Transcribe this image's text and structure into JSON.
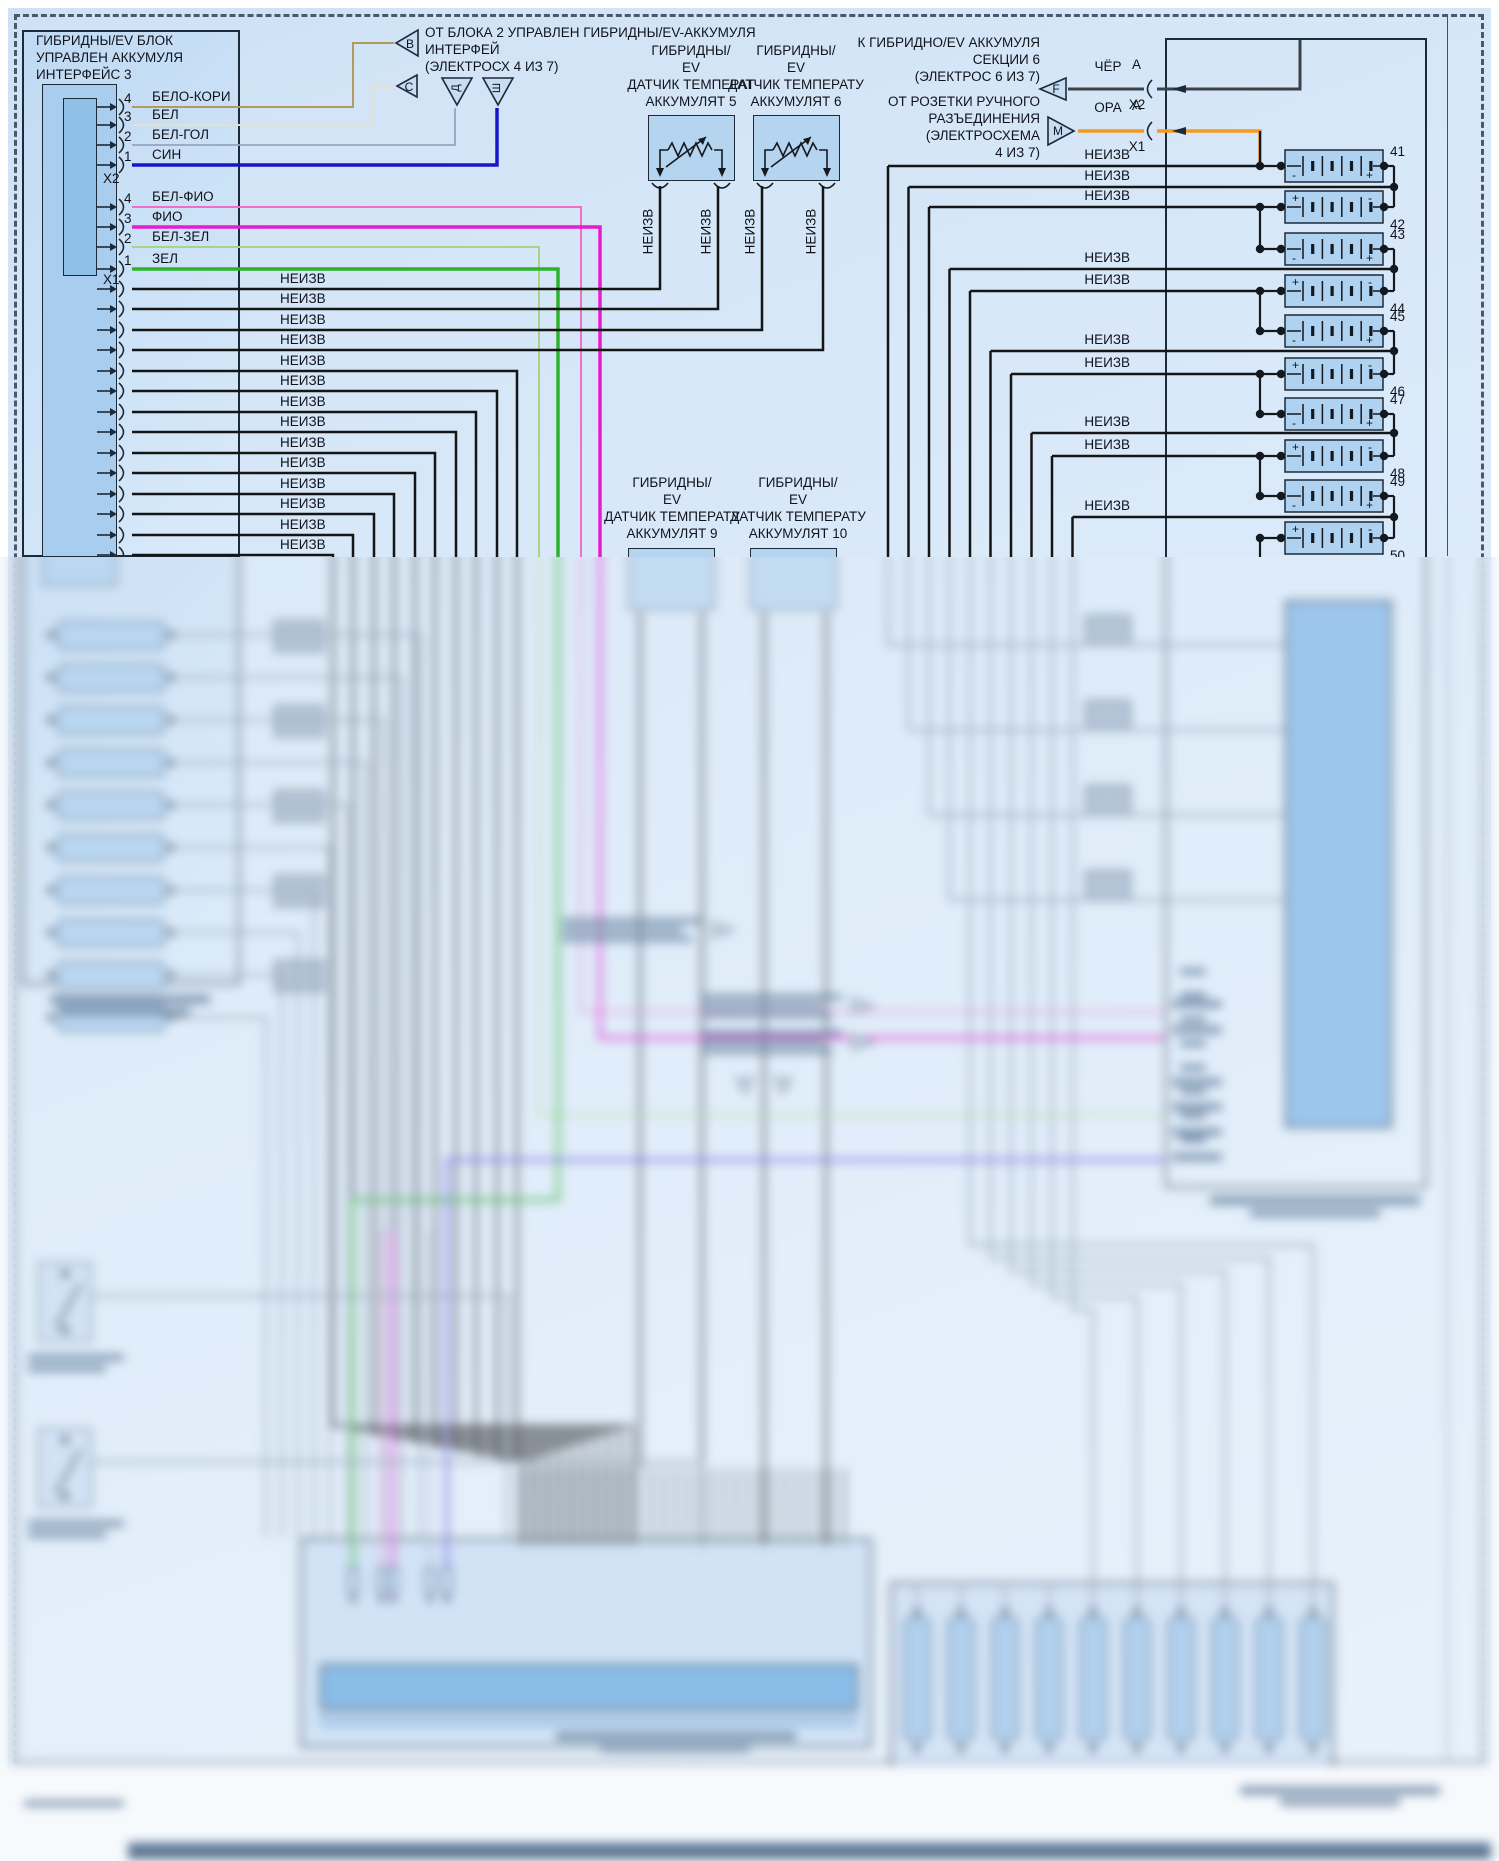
{
  "palette": {
    "diagram_bg": "#dcebfa",
    "block_fill": "#c6ddf3",
    "inner_fill": "#a9cdee",
    "inner_fill2": "#8fc0e8",
    "cell_fill": "#aed2f0",
    "line_dark": "#1c2a3a",
    "wire_black": "#151515",
    "wire_tan": "#b29b5e",
    "wire_white": "#e4e0cf",
    "wire_pale_blue": "#99a3c4",
    "wire_blue": "#1616c8",
    "wire_pink": "#f06ec8",
    "wire_magenta": "#e51cd0",
    "wire_pale_green": "#a6d584",
    "wire_green": "#2cb32c",
    "wire_gray": "#7d8da1",
    "wire_orange": "#f59a1c",
    "wire_dark_gray": "#3c4147",
    "wire_violet": "#6a5ae0"
  },
  "left_block": {
    "title_lines": [
      "ГИБРИДНЫ/EV БЛОК",
      "УПРАВЛЕН АККУМУЛЯ",
      "ИНТЕРФЕЙС 3"
    ],
    "x2_label": "X2",
    "x1_label": "X1",
    "x2_pins": [
      {
        "num": "4",
        "wire": "БЕЛО-КОРИ"
      },
      {
        "num": "3",
        "wire": "БЕЛ"
      },
      {
        "num": "2",
        "wire": "БЕЛ-ГОЛ"
      },
      {
        "num": "1",
        "wire": "СИН"
      }
    ],
    "x1_pins": [
      {
        "num": "4",
        "wire": "БЕЛ-ФИО"
      },
      {
        "num": "3",
        "wire": "ФИО"
      },
      {
        "num": "2",
        "wire": "БЕЛ-ЗЕЛ"
      },
      {
        "num": "1",
        "wire": "ЗЕЛ"
      }
    ],
    "unknown_wire_label": "НЕИЗВ",
    "unknown_left_count": 14
  },
  "top_note": {
    "lines": [
      "ОТ БЛОКА 2 УПРАВЛЕН ГИБРИДНЫ/EV-АККУМУЛЯ",
      "ИНТЕРФЕЙ",
      "(ЭЛЕКТРОСХ 4 ИЗ 7)"
    ],
    "refs": {
      "b": "В",
      "c": "С",
      "d": "Д",
      "sh": "Ш"
    }
  },
  "sensors": {
    "s5_lines": [
      "ГИБРИДНЫ/",
      "EV",
      "ДАТЧИК ТЕМПЕРАТ",
      "АККУМУЛЯТ 5"
    ],
    "s6_lines": [
      "ГИБРИДНЫ/",
      "EV",
      "ДАТЧИК ТЕМПЕРАТУ",
      "АККУМУЛЯТ 6"
    ],
    "s9_lines": [
      "ГИБРИДНЫ/",
      "EV",
      "ДАТЧИК ТЕМПЕРАТУ",
      "АККУМУЛЯТ 9"
    ],
    "s10_lines": [
      "ГИБРИДНЫ/",
      "EV",
      "ДАТЧИК ТЕМПЕРАТУ",
      "АККУМУЛЯТ 10"
    ],
    "wire_label": "НЕИЗВ"
  },
  "right_notes": {
    "to_section_lines": [
      "К ГИБРИДНО/EV АККУМУЛЯ",
      "СЕКЦИИ 6",
      "(ЭЛЕКТРОС 6 ИЗ 7)"
    ],
    "from_socket_lines": [
      "ОТ РОЗЕТКИ РУЧНОГО",
      "РАЗЪЕДИНЕНИЯ",
      "(ЭЛЕКТРОСХЕМА",
      "4 ИЗ 7)"
    ]
  },
  "connector_f": {
    "ref": "F",
    "wire_color": "ЧЁР",
    "pin": "A",
    "plug": "X2"
  },
  "connector_m": {
    "ref": "M",
    "wire_color": "ОРА",
    "pin": "A",
    "plug": "X1"
  },
  "battery": {
    "cell_numbers": [
      "41",
      "42",
      "43",
      "44",
      "45",
      "46",
      "47",
      "48",
      "49",
      "50"
    ],
    "plus_sign": "+",
    "minus_sign": "-",
    "tap_label": "НЕИЗВ",
    "tap_count": 10
  }
}
